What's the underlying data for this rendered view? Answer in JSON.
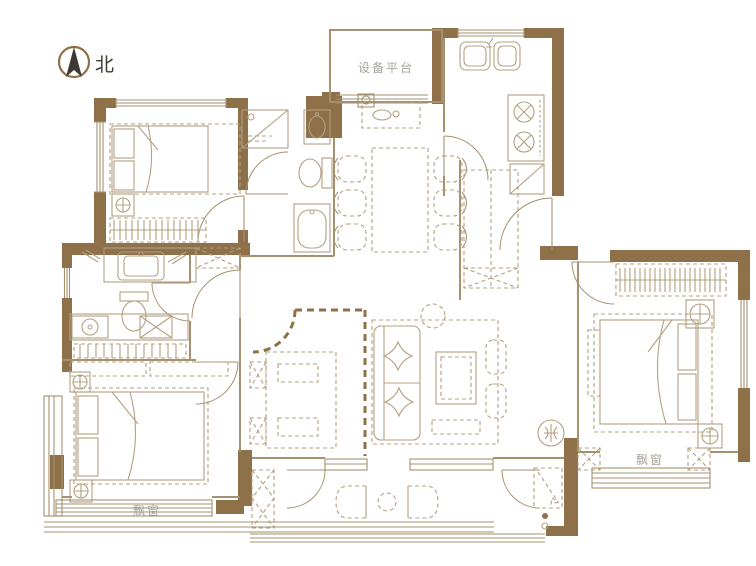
{
  "labels": {
    "north": "北",
    "equipment_platform": "设备平台",
    "bay_window_southwest": "飘窗",
    "bay_window_southeast": "飘窗"
  },
  "colors": {
    "wall": "#8e7149",
    "line": "#a5906f",
    "furniture": "#b3a082",
    "dark_text": "#3e3a33",
    "muted_text": "#a8a49a",
    "background": "#ffffff"
  }
}
